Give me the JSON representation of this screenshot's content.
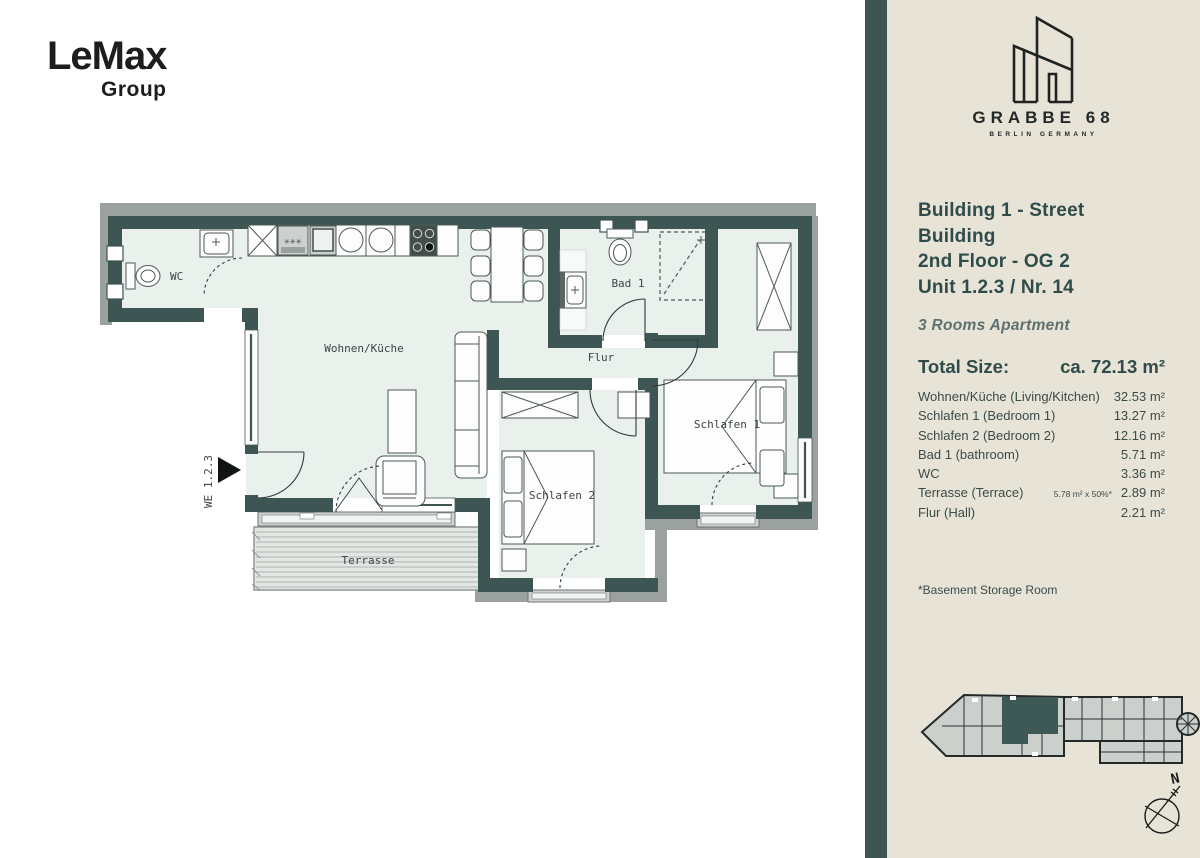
{
  "brand": {
    "name": "LeMax",
    "sub": "Group"
  },
  "project": {
    "name": "GRABBE 68",
    "location": "BERLIN GERMANY"
  },
  "unit": {
    "line1": "Building 1 - Street Building",
    "line2": "2nd Floor - OG 2",
    "line3": "Unit 1.2.3 / Nr. 14",
    "type": "3 Rooms Apartment",
    "total_label": "Total Size:",
    "total_value": "ca. 72.13 m²"
  },
  "size_table": {
    "rows": [
      {
        "label": "Wohnen/Küche (Living/Kitchen)",
        "note": "",
        "value": "32.53 m²"
      },
      {
        "label": "Schlafen 1 (Bedroom 1)",
        "note": "",
        "value": "13.27 m²"
      },
      {
        "label": "Schlafen 2 (Bedroom 2)",
        "note": "",
        "value": "12.16 m²"
      },
      {
        "label": "Bad 1 (bathroom)",
        "note": "",
        "value": "5.71 m²"
      },
      {
        "label": "WC",
        "note": "",
        "value": "3.36 m²"
      },
      {
        "label": "Terrasse (Terrace)",
        "note": "5.78 m² x 50%*",
        "value": "2.89 m²"
      },
      {
        "label": "Flur (Hall)",
        "note": "",
        "value": "2.21 m²"
      }
    ],
    "footnote": "*Basement Storage Room"
  },
  "floor_plan": {
    "labels": {
      "wc": "WC",
      "living": "Wohnen/Küche",
      "bad": "Bad 1",
      "flur": "Flur",
      "bedroom1": "Schlafen 1",
      "bedroom2": "Schlafen 2",
      "terrace": "Terrasse",
      "unit_id": "WE 1.2.3"
    }
  },
  "compass": {
    "north": "N"
  },
  "colors": {
    "wall": "#3d5553",
    "sidebar": "#e8e3d7",
    "floor": "#eaf0ec",
    "text_accent": "#2f4c4b"
  }
}
